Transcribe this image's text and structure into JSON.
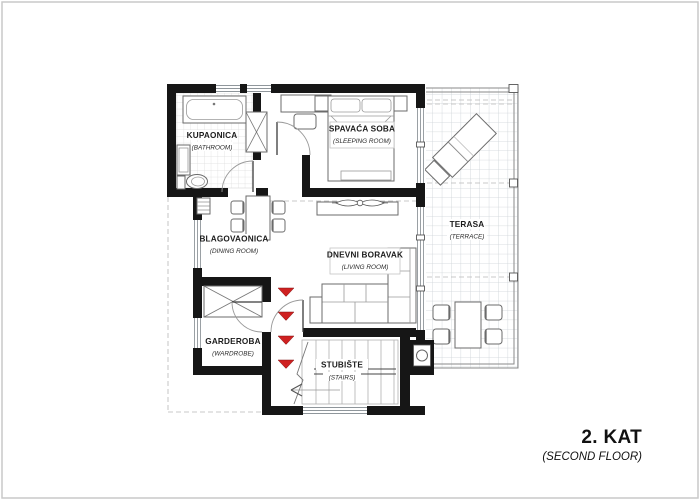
{
  "plan": {
    "floor_label": "2. KAT",
    "floor_sublabel": "(SECOND FLOOR)"
  },
  "rooms": {
    "bathroom": {
      "label": "KUPAONICA",
      "sublabel": "(BATHROOM)"
    },
    "bedroom": {
      "label": "SPAVAĆA SOBA",
      "sublabel": "(SLEEPING ROOM)"
    },
    "dining_room": {
      "label": "BLAGOVAONICA",
      "sublabel": "(DINING ROOM)"
    },
    "living_room": {
      "label": "DNEVNI BORAVAK",
      "sublabel": "(LIVING ROOM)"
    },
    "wardrobe": {
      "label": "GARDEROBA",
      "sublabel": "(WARDROBE)"
    },
    "stairs": {
      "label": "STUBIŠTE",
      "sublabel": "(STAIRS)"
    },
    "terrace": {
      "label": "TERASA",
      "sublabel": "(TERRACE)"
    }
  },
  "colors": {
    "wall": "#161616",
    "stair_arrow": "#cf2121",
    "paper": "#ffffff",
    "frame": "#c9c9c9",
    "tile_line": "#cdd2d6"
  }
}
